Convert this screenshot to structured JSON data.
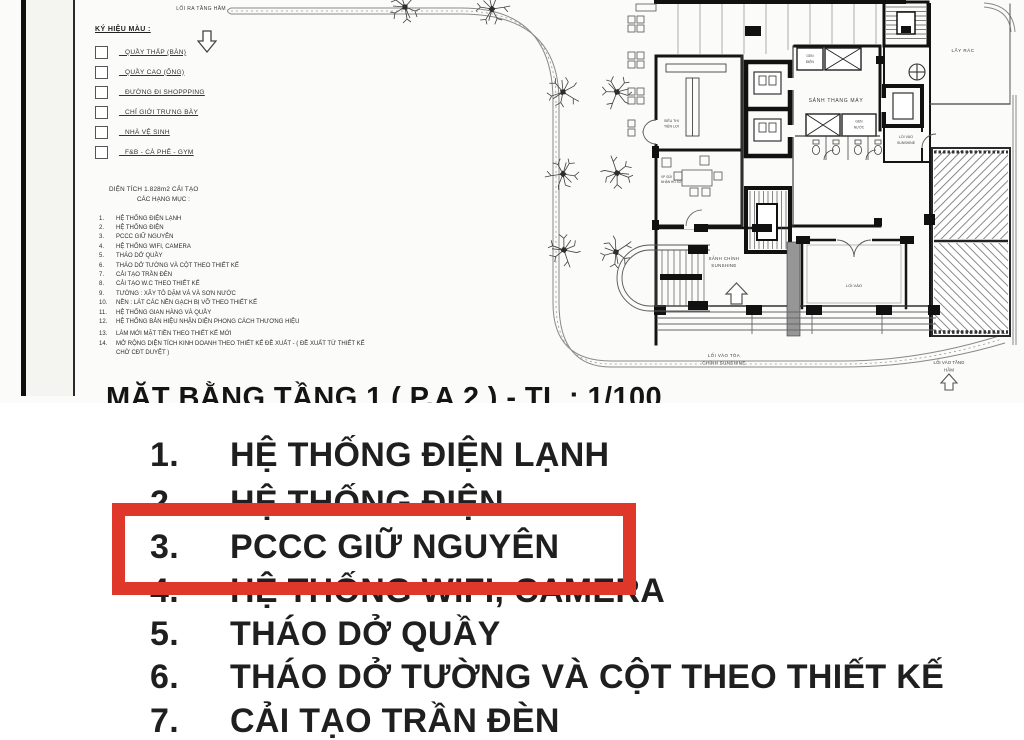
{
  "drawing": {
    "road_exit_label": "LỐI RA TẦNG HẦM",
    "legend": {
      "title": "KÝ HIỆU MÀU :",
      "items": [
        {
          "label": "_ QUẦY THẤP (BÀN)"
        },
        {
          "label": "_ QUẦY CAO (ỐNG)"
        },
        {
          "label": "_ ĐƯỜNG ĐI SHOPPPING"
        },
        {
          "label": "_ CHỈ GIỚI TRƯNG BÀY"
        },
        {
          "label": "_ NHÀ VỆ SINH"
        },
        {
          "label": "_ F&B - CÀ PHÊ - GYM"
        }
      ]
    },
    "scope": {
      "line1": "DIỆN TÍCH 1.828m2 CẢI TẠO",
      "line2": "CÁC HẠNG MỤC :",
      "items": [
        {
          "num": "1.",
          "text": "HỆ THỐNG ĐIỆN LẠNH"
        },
        {
          "num": "2.",
          "text": "HỆ THỐNG ĐIỆN"
        },
        {
          "num": "3.",
          "text": "PCCC GIỮ NGUYÊN"
        },
        {
          "num": "4.",
          "text": "HỆ THỐNG WIFI, CAMERA"
        },
        {
          "num": "5.",
          "text": "THÁO DỞ QUẦY"
        },
        {
          "num": "6.",
          "text": "THÁO DỞ TƯỜNG VÀ CỘT THEO THIẾT KẾ"
        },
        {
          "num": "7.",
          "text": "CẢI TẠO TRẦN ĐÈN"
        },
        {
          "num": "8.",
          "text": "CẢI TẠO W.C THEO THIẾT KẾ"
        },
        {
          "num": "9.",
          "text": "TƯỜNG : XÂY TÔ DẶM VÁ VÀ SƠN NƯỚC"
        },
        {
          "num": "10.",
          "text": "NỀN : LÁT CÁC NỀN GẠCH BỊ VỠ THEO THIẾT KẾ"
        },
        {
          "num": "11.",
          "text": "HỆ THỐNG GIAN HÀNG VÀ QUẦY"
        },
        {
          "num": "12.",
          "text": "HỆ THỐNG BẢN HIỆU NHẬN DIỆN PHONG CÁCH THƯƠNG HIỆU"
        },
        {
          "num": "13.",
          "text": "LÀM MỚI MẶT TIỀN THEO THIẾT KẾ MỚI"
        },
        {
          "num": "14.",
          "text": "MỞ RỘNG DIỆN TÍCH KINH DOANH THEO THIẾT KẾ ĐỀ XUẤT - ( ĐỀ XUẤT TỪ THIẾT KẾ CHỜ CĐT DUYỆT )"
        }
      ]
    },
    "plan": {
      "store_l1": "SIÊU THỊ",
      "store_l2": "TIỆN LỢI",
      "office_l1": "VP GỬI",
      "office_l2": "NHẬN HỒ SƠ",
      "gen_e_l1": "GEN",
      "gen_e_l2": "ĐIỆN",
      "gen_w_l1": "GEN",
      "gen_w_l2": "NƯỚC",
      "lift_lobby": "SẢNH THANG MÁY",
      "trash": "LẤY RÁC",
      "side_entry_l1": "LỐI VÀO",
      "side_entry_l2": "SUNSHINE",
      "main_hall_l1": "SẢNH CHÍNH",
      "main_hall_l2": "SUNSHINE",
      "shop_entry": "LỐI VÀO",
      "main_entry_l1": "LỐI VÀO TÒA",
      "main_entry_l2": "CHÍNH SUNSHINE",
      "ramp_entry_l1": "LỐI VÀO TẦNG",
      "ramp_entry_l2": "HẦM"
    },
    "sheet_title": "MẶT BẰNG TẦNG 1 ( P.A 2 ) - TL : 1/100"
  },
  "zoom_list": {
    "highlight_color": "#e0372b",
    "items": [
      {
        "num": "1.",
        "text": "HỆ THỐNG ĐIỆN LẠNH"
      },
      {
        "num": "2.",
        "text": "HỆ THỐNG ĐIỆN"
      },
      {
        "num": "3.",
        "text": "PCCC GIỮ NGUYÊN"
      },
      {
        "num": "4.",
        "text": "HỆ THỐNG WIFI, CAMERA"
      },
      {
        "num": "5.",
        "text": "THÁO DỞ QUẦY"
      },
      {
        "num": "6.",
        "text": "THÁO DỞ TƯỜNG VÀ CỘT THEO THIẾT KẾ"
      },
      {
        "num": "7.",
        "text": "CẢI TẠO TRẦN ĐÈN"
      }
    ]
  }
}
